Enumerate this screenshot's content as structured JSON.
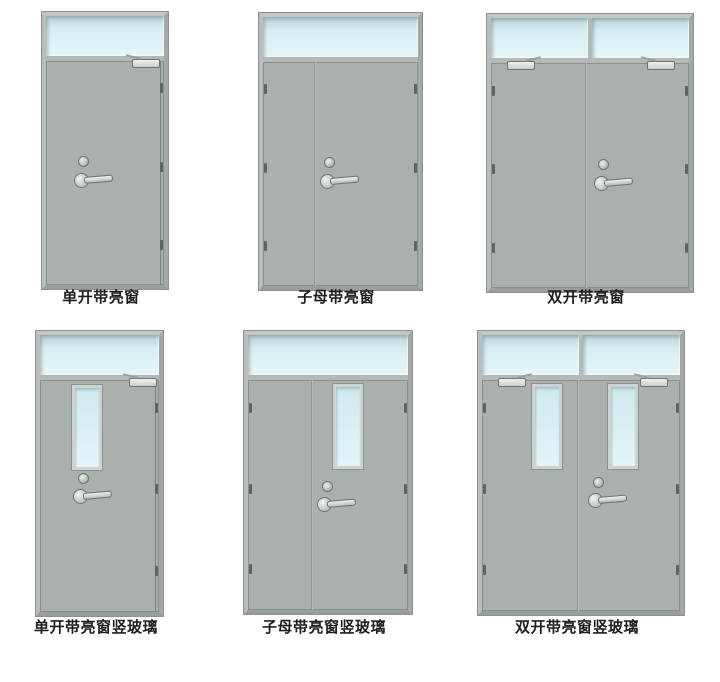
{
  "page": {
    "description": "Steel fire door style catalog, six door diagrams in two rows"
  },
  "colors": {
    "background": "#ffffff",
    "frame": "#b3b9b7",
    "frame_edge": "#8b918e",
    "panel": "#a9b0ad",
    "panel_edge": "#7c837f",
    "glass": "#d8eef3",
    "glass_dark": "#b9d3d9",
    "hardware": "#c9cecc",
    "hardware_edge": "#6d7471",
    "label_color": "#1e1e1e"
  },
  "doors": [
    {
      "label": "单开带亮窗",
      "type": "single leaf with transom window"
    },
    {
      "label": "子母带亮窗",
      "type": "unequal double leaf with transom window"
    },
    {
      "label": "双开带亮窗",
      "type": "double leaf with transom window"
    },
    {
      "label": "单开带亮窗竖玻璃",
      "type": "single leaf with transom window and vertical vision glass"
    },
    {
      "label": "子母带亮窗竖玻璃",
      "type": "unequal double leaf with transom window and vertical vision glass"
    },
    {
      "label": "双开带亮窗竖玻璃",
      "type": "double leaf with transom window and vertical vision glass"
    }
  ]
}
